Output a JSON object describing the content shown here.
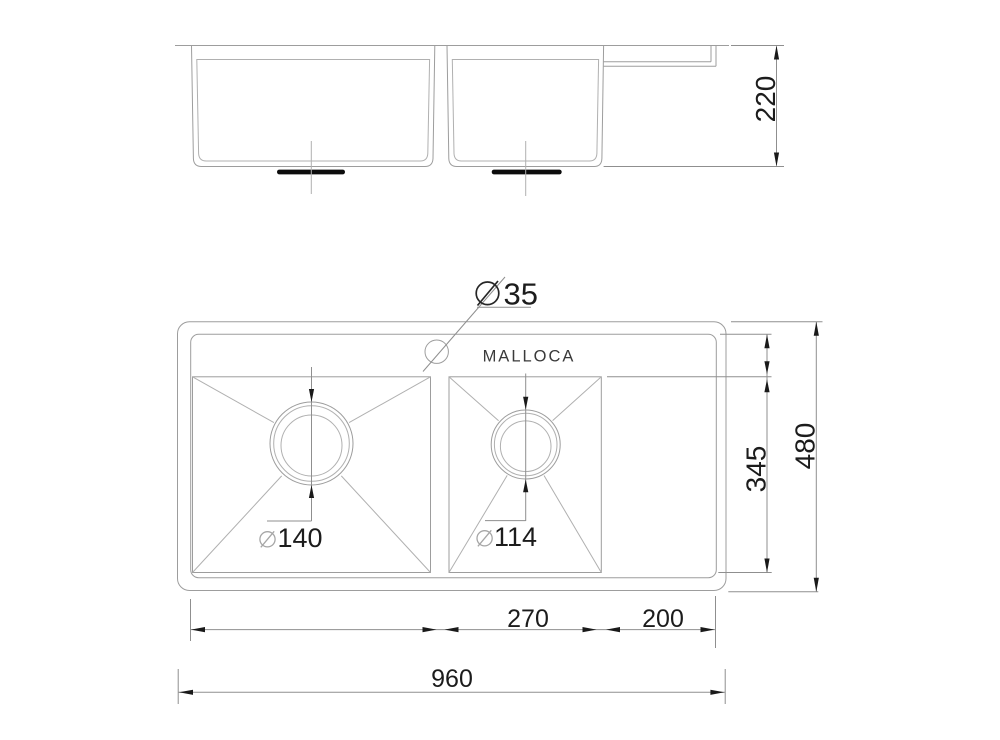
{
  "drawing": {
    "brand": "MALLOCA",
    "type": "sink-dimension-drawing",
    "side_view": {
      "depth": "220"
    },
    "plan_view": {
      "diameter_symbol": "⌀",
      "faucet_hole_diameter": "35",
      "left_drain_diameter": "140",
      "right_drain_diameter": "114"
    },
    "dimensions": {
      "overall_width": "960",
      "overall_depth": "480",
      "bowl_front_to_back": "345",
      "right_bowl_width": "270",
      "drainboard_width": "200"
    },
    "colors": {
      "line_gray": "#9d9d9d",
      "dim_gray": "#8f8f8f",
      "text_ink": "#1c1c1c",
      "drain_black": "#0c0c0c",
      "background": "#ffffff"
    }
  }
}
